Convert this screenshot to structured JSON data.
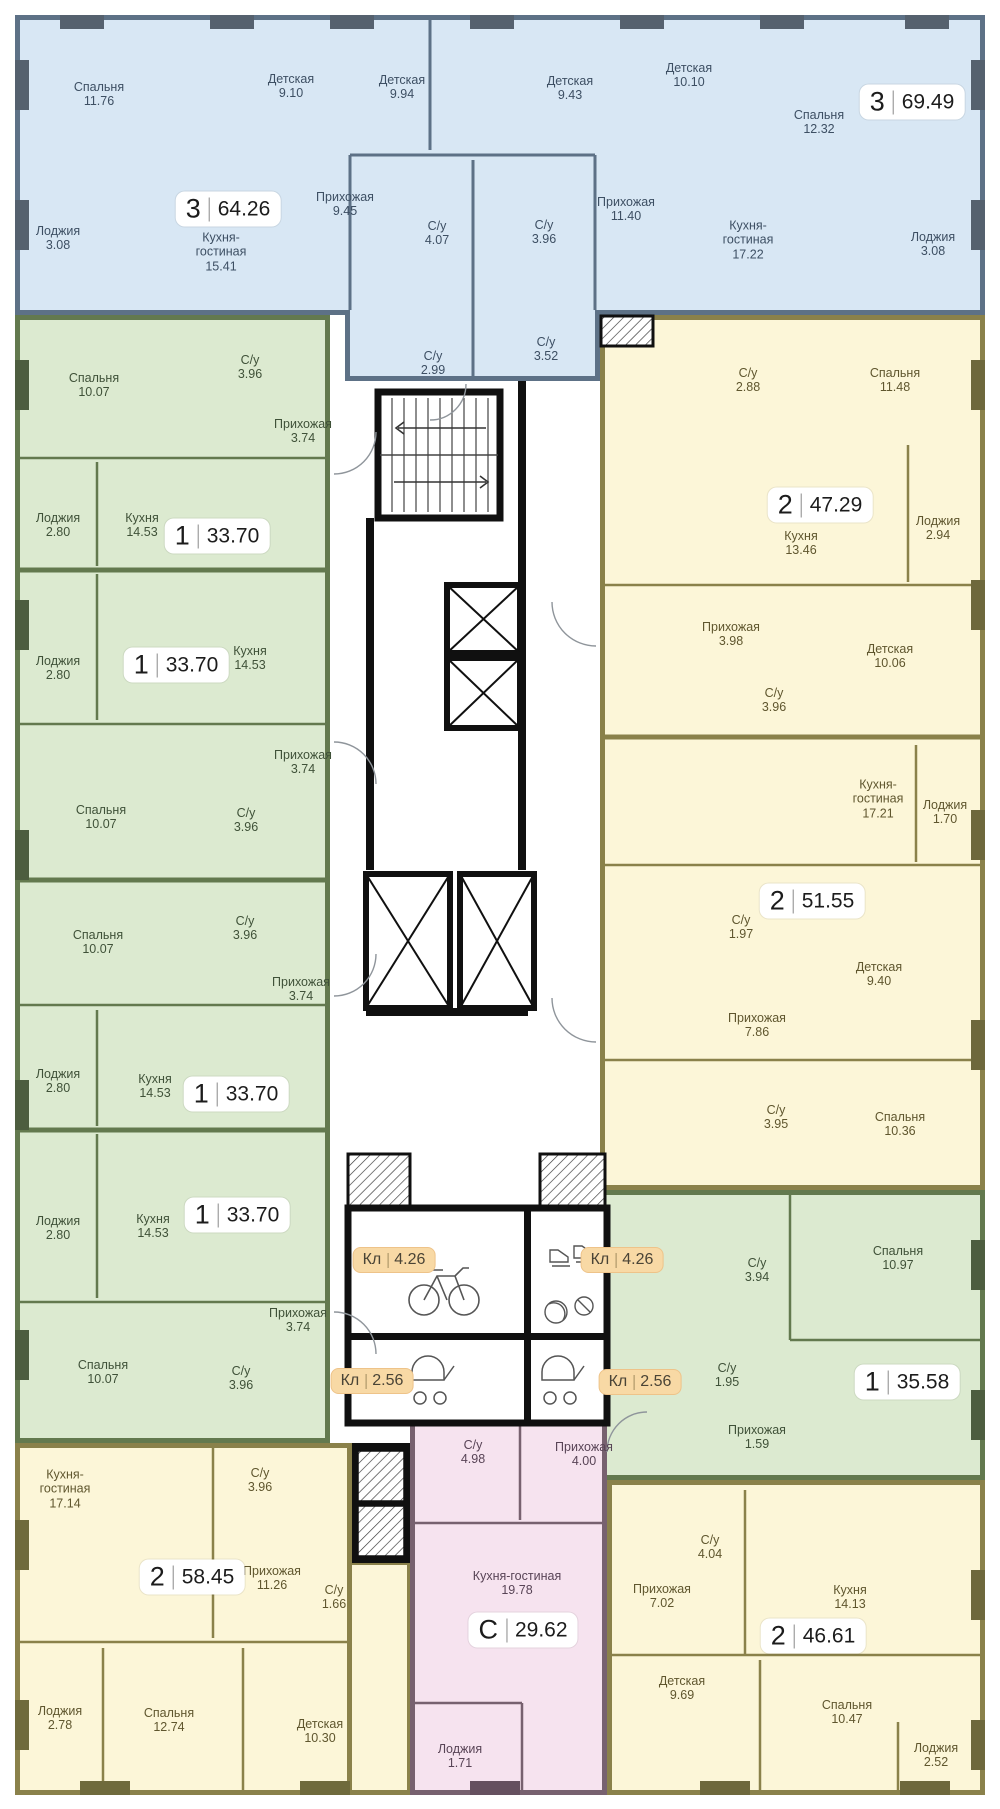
{
  "colors": {
    "blue_fill": "#d8e7f4",
    "blue_wall": "#5d7186",
    "green_fill": "#dcead0",
    "green_wall": "#63794e",
    "yellow_fill": "#fcf6d8",
    "yellow_wall": "#8a814a",
    "pink_fill": "#f6e3ef",
    "pink_wall": "#77616f",
    "storage_badge_bg": "#f8d9a5",
    "badge_bg": "#ffffff",
    "core_wall": "#101010"
  },
  "apartments": [
    {
      "id": "apt-3-6426",
      "type": "3",
      "area": "64.26",
      "color": "blue",
      "rooms": [
        {
          "name": "Спальня",
          "area": "11.76"
        },
        {
          "name": "Детская",
          "area": "9.10"
        },
        {
          "name": "Детская",
          "area": "9.94"
        },
        {
          "name": "Прихожая",
          "area": "9.45"
        },
        {
          "name": "С/у",
          "area": "4.07"
        },
        {
          "name": "С/у",
          "area": "2.99"
        },
        {
          "name": "Кухня-гостиная",
          "area": "15.41"
        },
        {
          "name": "Лоджия",
          "area": "3.08"
        }
      ]
    },
    {
      "id": "apt-3-6949",
      "type": "3",
      "area": "69.49",
      "color": "blue",
      "rooms": [
        {
          "name": "Детская",
          "area": "9.43"
        },
        {
          "name": "Детская",
          "area": "10.10"
        },
        {
          "name": "Спальня",
          "area": "12.32"
        },
        {
          "name": "Прихожая",
          "area": "11.40"
        },
        {
          "name": "С/у",
          "area": "3.96"
        },
        {
          "name": "С/у",
          "area": "3.52"
        },
        {
          "name": "Кухня-гостиная",
          "area": "17.22"
        },
        {
          "name": "Лоджия",
          "area": "3.08"
        }
      ]
    },
    {
      "id": "apt-1-3370-a",
      "type": "1",
      "area": "33.70",
      "color": "green",
      "rooms": [
        {
          "name": "Спальня",
          "area": "10.07"
        },
        {
          "name": "С/у",
          "area": "3.96"
        },
        {
          "name": "Прихожая",
          "area": "3.74"
        },
        {
          "name": "Кухня",
          "area": "14.53"
        },
        {
          "name": "Лоджия",
          "area": "2.80"
        }
      ]
    },
    {
      "id": "apt-1-3370-b",
      "type": "1",
      "area": "33.70",
      "color": "green",
      "rooms": [
        {
          "name": "Лоджия",
          "area": "2.80"
        },
        {
          "name": "Кухня",
          "area": "14.53"
        },
        {
          "name": "Прихожая",
          "area": "3.74"
        },
        {
          "name": "Спальня",
          "area": "10.07"
        },
        {
          "name": "С/у",
          "area": "3.96"
        }
      ]
    },
    {
      "id": "apt-1-3370-c",
      "type": "1",
      "area": "33.70",
      "color": "green",
      "rooms": [
        {
          "name": "Спальня",
          "area": "10.07"
        },
        {
          "name": "С/у",
          "area": "3.96"
        },
        {
          "name": "Прихожая",
          "area": "3.74"
        },
        {
          "name": "Кухня",
          "area": "14.53"
        },
        {
          "name": "Лоджия",
          "area": "2.80"
        }
      ]
    },
    {
      "id": "apt-1-3370-d",
      "type": "1",
      "area": "33.70",
      "color": "green",
      "rooms": [
        {
          "name": "Лоджия",
          "area": "2.80"
        },
        {
          "name": "Кухня",
          "area": "14.53"
        },
        {
          "name": "Прихожая",
          "area": "3.74"
        },
        {
          "name": "Спальня",
          "area": "10.07"
        },
        {
          "name": "С/у",
          "area": "3.96"
        }
      ]
    },
    {
      "id": "apt-2-4729",
      "type": "2",
      "area": "47.29",
      "color": "yellow",
      "rooms": [
        {
          "name": "С/у",
          "area": "2.88"
        },
        {
          "name": "Спальня",
          "area": "11.48"
        },
        {
          "name": "Кухня",
          "area": "13.46"
        },
        {
          "name": "Лоджия",
          "area": "2.94"
        },
        {
          "name": "Прихожая",
          "area": "3.98"
        },
        {
          "name": "Детская",
          "area": "10.06"
        },
        {
          "name": "С/у",
          "area": "3.96"
        }
      ]
    },
    {
      "id": "apt-2-5155",
      "type": "2",
      "area": "51.55",
      "color": "yellow",
      "rooms": [
        {
          "name": "Кухня-гостиная",
          "area": "17.21"
        },
        {
          "name": "Лоджия",
          "area": "1.70"
        },
        {
          "name": "С/у",
          "area": "1.97"
        },
        {
          "name": "Детская",
          "area": "9.40"
        },
        {
          "name": "Прихожая",
          "area": "7.86"
        },
        {
          "name": "С/у",
          "area": "3.95"
        },
        {
          "name": "Спальня",
          "area": "10.36"
        }
      ]
    },
    {
      "id": "apt-1-3558",
      "type": "1",
      "area": "35.58",
      "color": "green",
      "rooms": [
        {
          "name": "С/у",
          "area": "3.94"
        },
        {
          "name": "Спальня",
          "area": "10.97"
        },
        {
          "name": "С/у",
          "area": "1.95"
        },
        {
          "name": "Прихожая",
          "area": "1.59"
        }
      ]
    },
    {
      "id": "apt-2-5845",
      "type": "2",
      "area": "58.45",
      "color": "yellow",
      "rooms": [
        {
          "name": "Кухня-гостиная",
          "area": "17.14"
        },
        {
          "name": "С/у",
          "area": "3.96"
        },
        {
          "name": "Прихожая",
          "area": "11.26"
        },
        {
          "name": "С/у",
          "area": "1.66"
        },
        {
          "name": "Лоджия",
          "area": "2.78"
        },
        {
          "name": "Спальня",
          "area": "12.74"
        },
        {
          "name": "Детская",
          "area": "10.30"
        }
      ]
    },
    {
      "id": "apt-s-2962",
      "type": "С",
      "area": "29.62",
      "color": "pink",
      "rooms": [
        {
          "name": "С/у",
          "area": "4.98"
        },
        {
          "name": "Прихожая",
          "area": "4.00"
        },
        {
          "name": "Кухня-гостиная",
          "area": "19.78"
        },
        {
          "name": "Лоджия",
          "area": "1.71"
        }
      ]
    },
    {
      "id": "apt-2-4661",
      "type": "2",
      "area": "46.61",
      "color": "yellow",
      "rooms": [
        {
          "name": "С/у",
          "area": "4.04"
        },
        {
          "name": "Прихожая",
          "area": "7.02"
        },
        {
          "name": "Кухня",
          "area": "14.13"
        },
        {
          "name": "Детская",
          "area": "9.69"
        },
        {
          "name": "Спальня",
          "area": "10.47"
        },
        {
          "name": "Лоджия",
          "area": "2.52"
        }
      ]
    }
  ],
  "storages": [
    {
      "label": "Кл",
      "area": "4.26"
    },
    {
      "label": "Кл",
      "area": "4.26"
    },
    {
      "label": "Кл",
      "area": "2.56"
    },
    {
      "label": "Кл",
      "area": "2.56"
    }
  ]
}
